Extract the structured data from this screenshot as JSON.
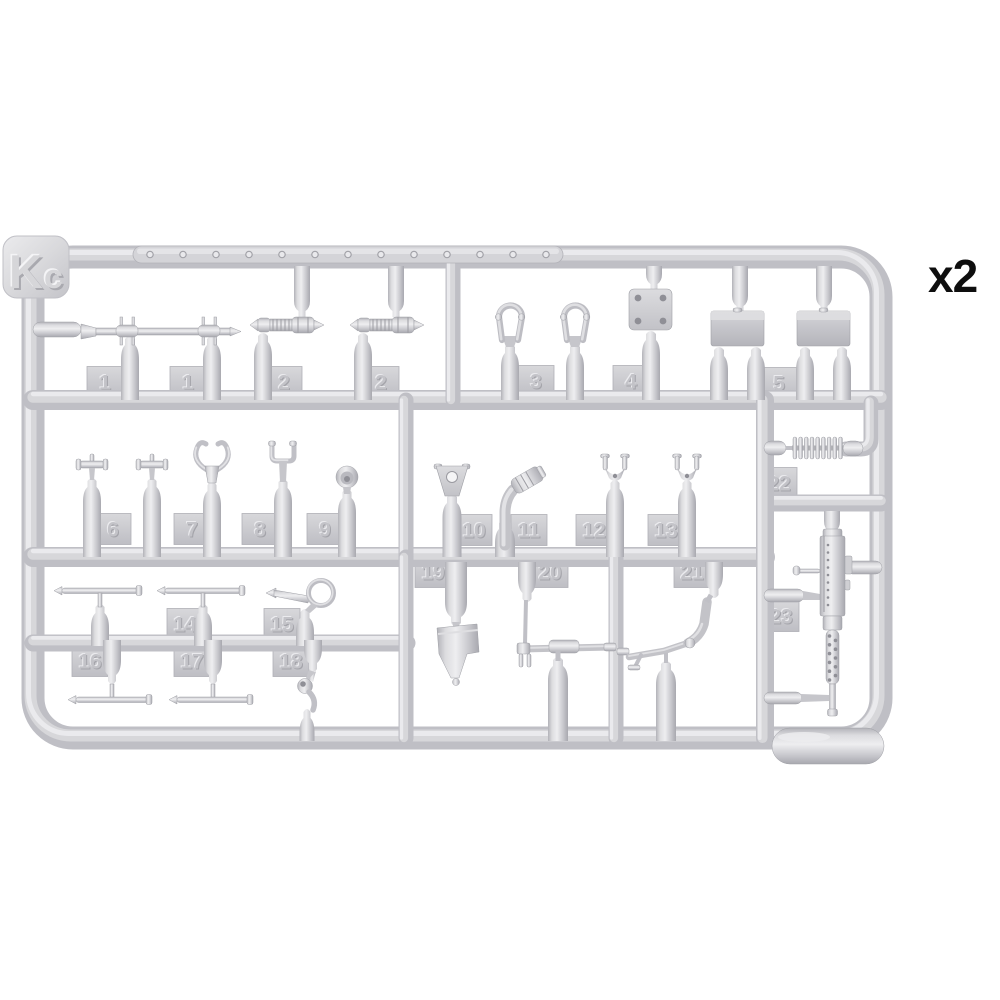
{
  "sprue": {
    "letter": "Kc",
    "quantity_label": "x2",
    "part_numbers": [
      "1",
      "1",
      "2",
      "2",
      "3",
      "4",
      "5",
      "6",
      "7",
      "8",
      "9",
      "10",
      "11",
      "12",
      "13",
      "14",
      "15",
      "16",
      "17",
      "18",
      "19",
      "20",
      "21",
      "22",
      "23"
    ]
  },
  "colors": {
    "background": "#ffffff",
    "plastic_mid": "#c6c6cb",
    "plastic_light": "#ececee",
    "plastic_dark": "#aeaeb4",
    "quantity_text": "#0e0e0e"
  }
}
